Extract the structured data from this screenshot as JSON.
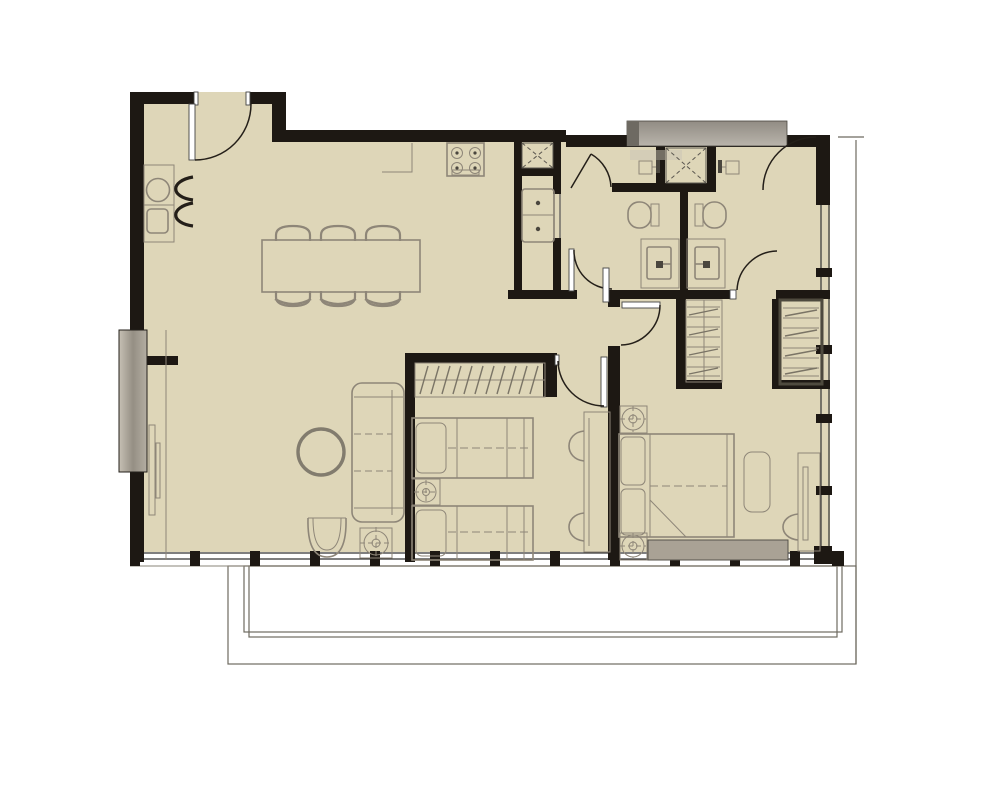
{
  "meta": {
    "description": "Architectural floor plan of a two-bedroom, two-bathroom apartment with open kitchen, living and dining area, utility closet, wardrobes and a full-width balcony below",
    "drawing_type": "floor-plan",
    "visible_text": []
  },
  "colors": {
    "floor": "#ded6b8",
    "wall": "#1d1813",
    "furn": "#8e8678",
    "furn_dark": "#6f6a5e",
    "glass": "#333333",
    "balc": "#6e6a60",
    "bench": "#a9a295",
    "lining": "#4e4a3e",
    "ext": "#b0aaa0",
    "white": "#ffffff"
  },
  "rooms": [
    {
      "name": "kitchen",
      "furniture": [
        "counter-with-sink",
        "under-counter-appliance",
        "faucet-chevrons",
        "gas-cooktop-4-burner",
        "counter-edge"
      ]
    },
    {
      "name": "dining-area",
      "furniture": [
        "dining-table",
        "chairs-top-row-3",
        "chairs-bottom-row-3"
      ]
    },
    {
      "name": "living-room",
      "furniture": [
        "wall-tv",
        "media-console-line",
        "round-coffee-table",
        "three-seat-sofa",
        "armchair",
        "floor-lamp"
      ]
    },
    {
      "name": "utility-closet",
      "furniture": [
        "vent-shaft-x",
        "stacked-washer-dryer"
      ]
    },
    {
      "name": "bathroom-left",
      "furniture": [
        "shower-stall-glass-door",
        "shower-sprayer",
        "toilet",
        "vanity-sink",
        "entry-door"
      ]
    },
    {
      "name": "bathroom-right",
      "furniture": [
        "shower-stall-glass-door",
        "shower-sprayer",
        "toilet",
        "vanity-sink",
        "entry-door"
      ]
    },
    {
      "name": "bedroom-2",
      "furniture": [
        "open-wardrobe-with-hangers",
        "twin-bed-1",
        "nightstand-lamp",
        "twin-bed-2",
        "desk",
        "chair-1",
        "chair-2"
      ]
    },
    {
      "name": "master-bedroom",
      "furniture": [
        "nightstand-lamp-1",
        "double-bed-with-folded-blanket",
        "cushion",
        "foot-bench",
        "nightstand-lamp-2",
        "dresser-with-mirror",
        "stool"
      ]
    },
    {
      "name": "hall-closet-left",
      "furniture": [
        "shelving"
      ]
    },
    {
      "name": "hall-closet-right",
      "furniture": [
        "shelving"
      ]
    },
    {
      "name": "balcony",
      "furniture": [
        "railing-outline"
      ]
    }
  ],
  "doors": [
    "entry-door-top-left",
    "shower-door-left",
    "shower-door-right",
    "bathroom-left-door",
    "bathroom-right-door",
    "master-bedroom-door",
    "bedroom-2-door"
  ],
  "windows": [
    "bottom-window-wall-with-mullions",
    "right-window-wall-with-mullions"
  ]
}
